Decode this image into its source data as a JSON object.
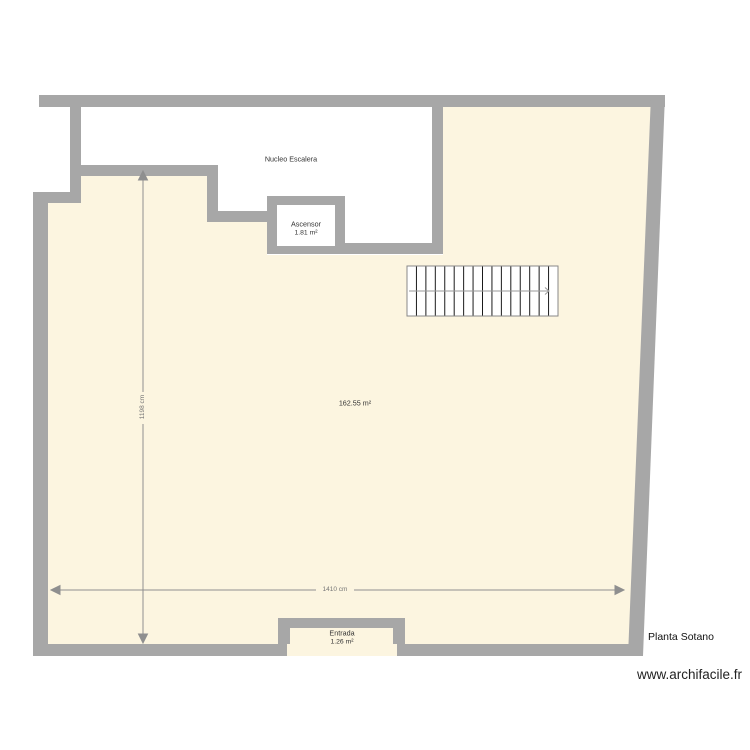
{
  "plan": {
    "title": "Planta Sotano",
    "watermark": "www.archifacile.fr",
    "rooms": {
      "stair_core": {
        "label": "Nucleo Escalera"
      },
      "elevator": {
        "label": "Ascensor",
        "area": "1.81 m²"
      },
      "main_room": {
        "area": "162.55 m²"
      },
      "entrance": {
        "label": "Entrada",
        "area": "1.26 m²"
      }
    },
    "dimensions": {
      "horizontal": "1410 cm",
      "vertical": "1198 cm"
    },
    "colors": {
      "wall": "#a7a7a7",
      "floor": "#fcf5e0",
      "stair_core_floor": "#ffffff",
      "dimension_line": "#8f8f8f",
      "stair_tread": "#1a1a1a",
      "label_text": "#333333"
    },
    "stair": {
      "tread_count": 16
    }
  }
}
